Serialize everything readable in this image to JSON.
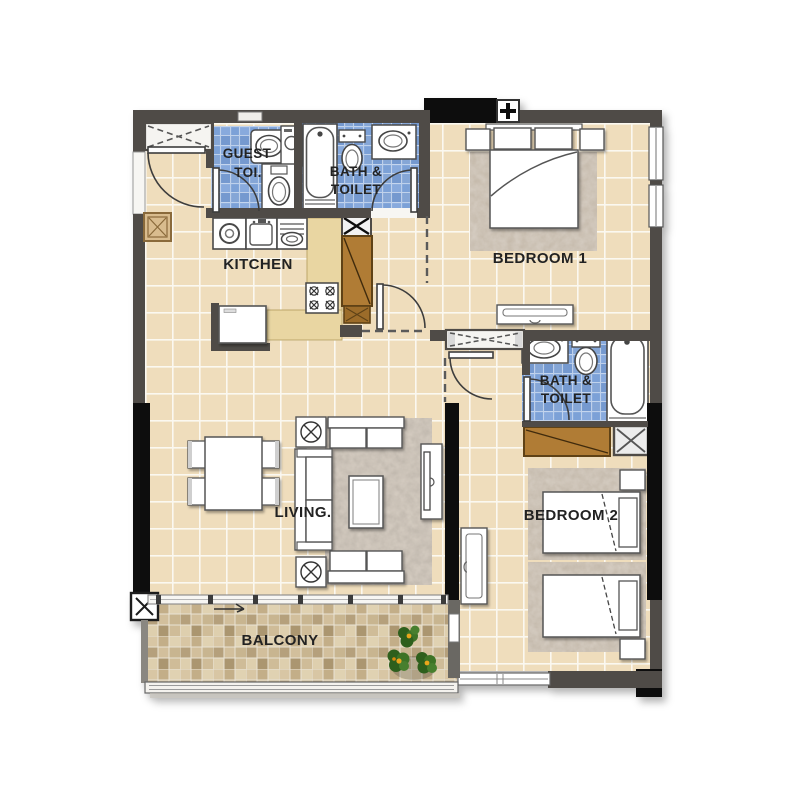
{
  "plan_title": "2 Bedroom Apartment Floor Plan",
  "rooms": {
    "guest_toilet": {
      "line1": "GUEST",
      "line2": "TOI."
    },
    "bath_upper": {
      "line1": "BATH &",
      "line2": "TOILET"
    },
    "kitchen": {
      "label": "KITCHEN"
    },
    "bedroom1": {
      "label": "BEDROOM 1"
    },
    "bath_lower": {
      "line1": "BATH &",
      "line2": "TOILET"
    },
    "bedroom2": {
      "label": "BEDROOM 2"
    },
    "living": {
      "label": "LIVING."
    },
    "balcony": {
      "label": "BALCONY"
    }
  },
  "palette": {
    "wall": "#4f4c47",
    "column": "#0d0d0d",
    "floor_tile": "#efddbc",
    "bath_tile": "#7ba1d7",
    "kitchen_counter": "#e9d6a2",
    "wood_cabinet": "#b07c34",
    "balcony_tile": "#cdb994",
    "rug": "#b3a99c",
    "label_text": "#242424"
  }
}
